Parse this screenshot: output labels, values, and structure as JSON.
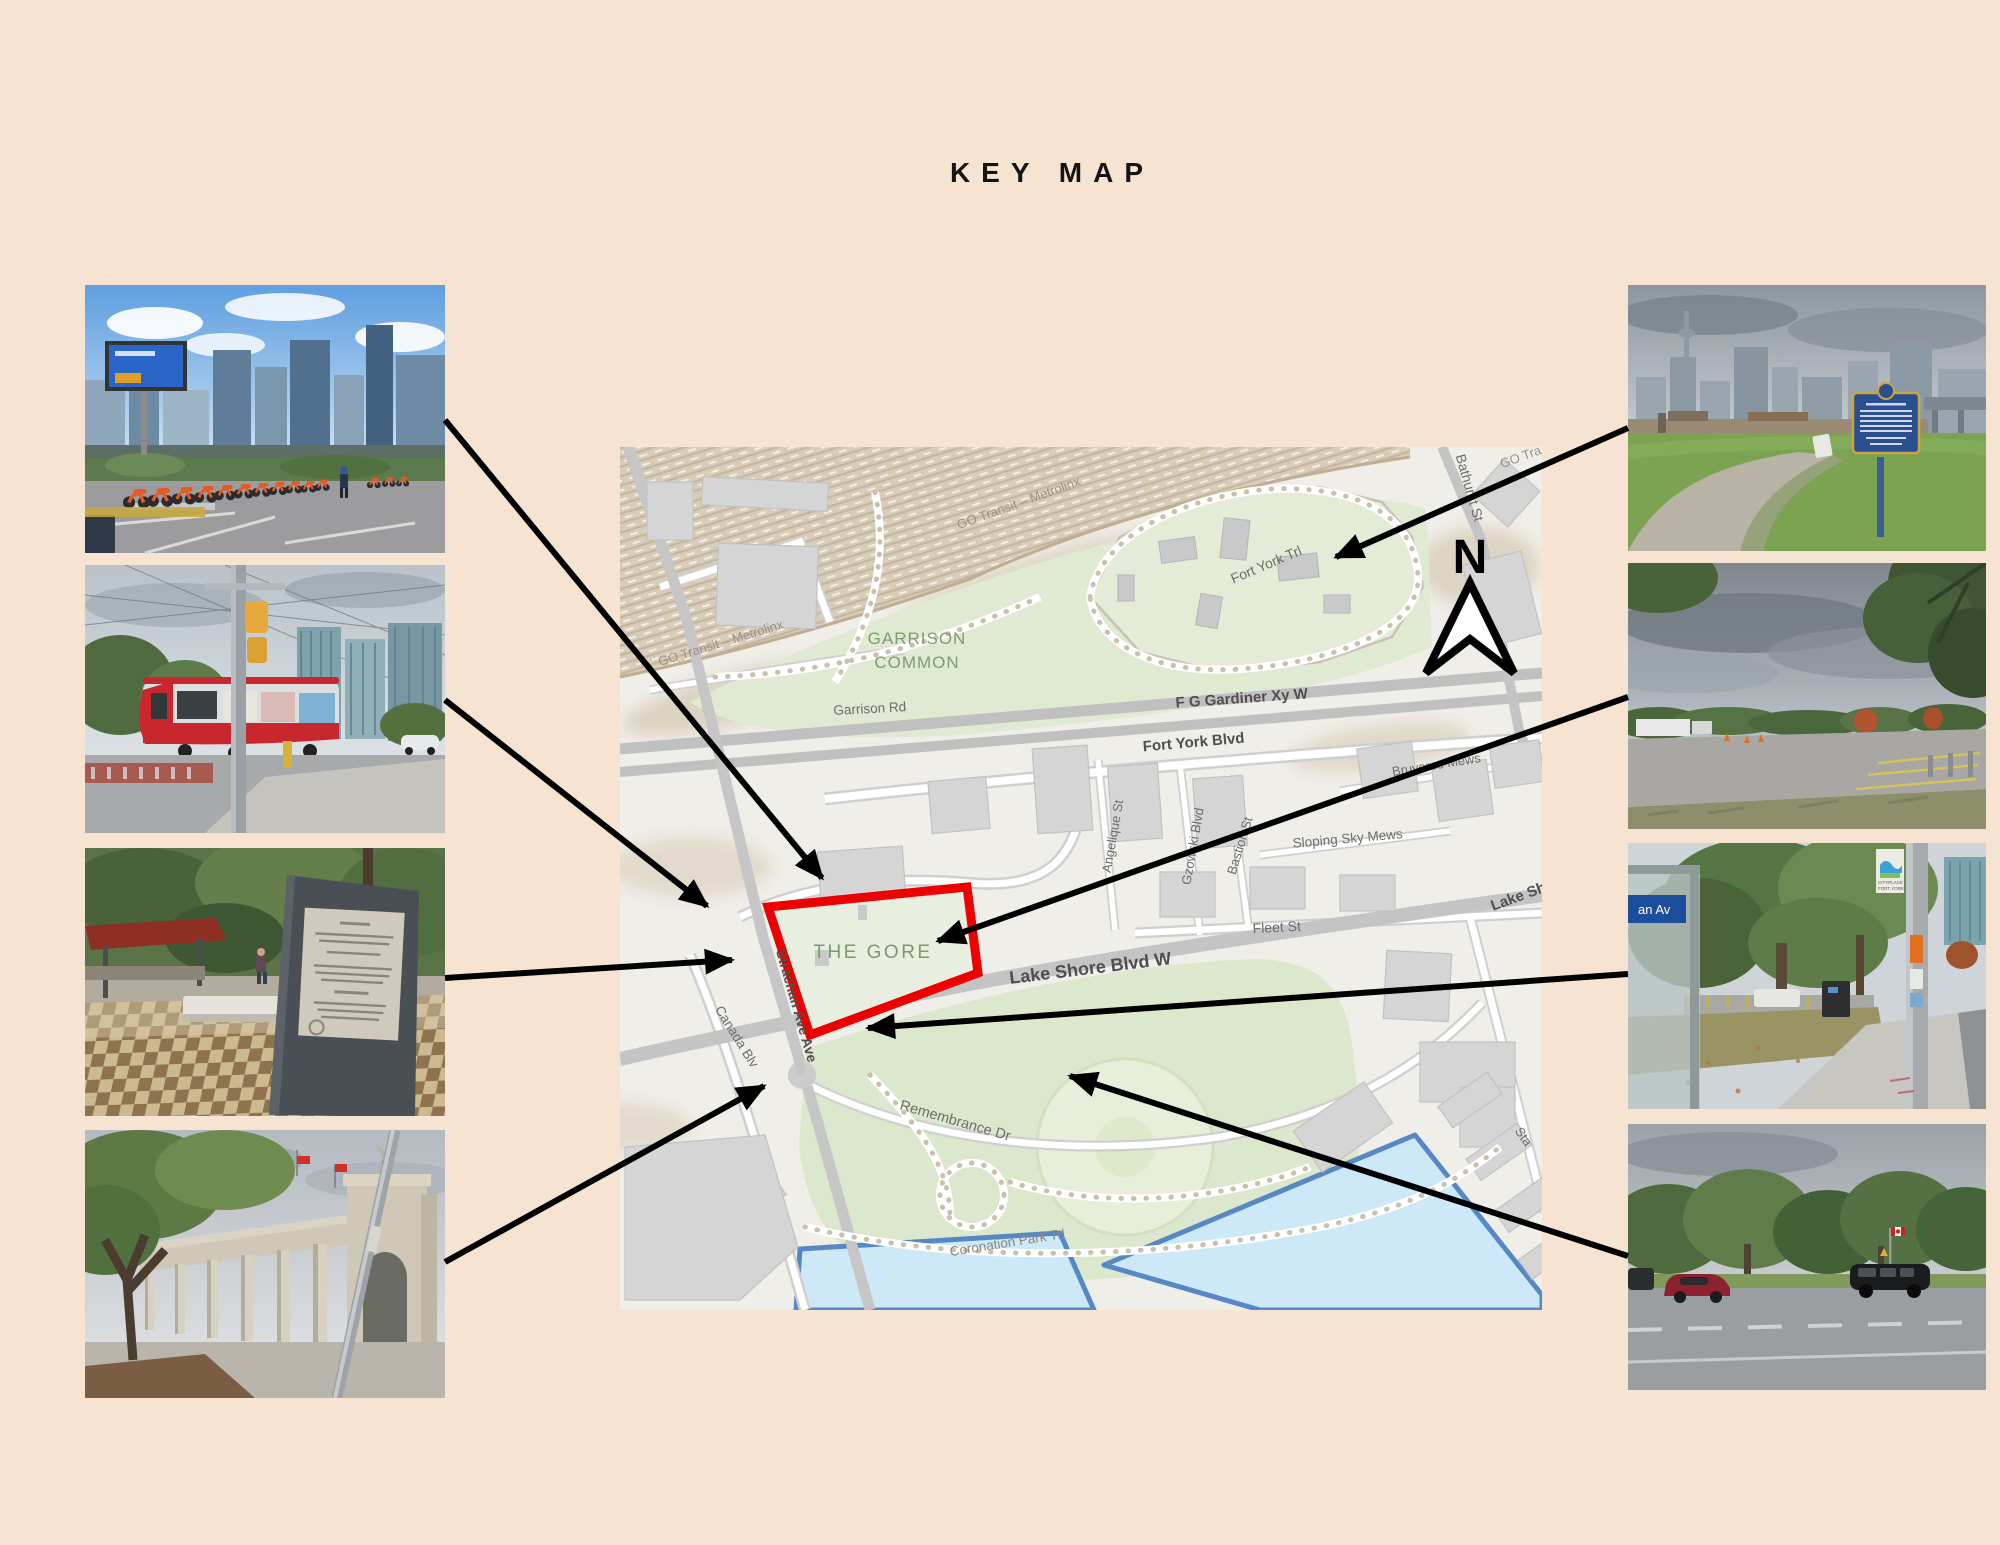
{
  "title": "KEY MAP",
  "map": {
    "labels": {
      "go_transit_1": "GO Transit – Metrolinx",
      "go_transit_2": "GO Transit – Metrolinx",
      "go_transit_3": "GO Tra",
      "garrison_common_1": "GARRISON",
      "garrison_common_2": "COMMON",
      "garrison_rd": "Garrison Rd",
      "fort_york_trl": "Fort York Trl",
      "gardiner": "F G Gardiner Xy W",
      "fort_york_blvd": "Fort York Blvd",
      "bruyeres_mews": "Bruyeres Mews",
      "sloping_sky_mews": "Sloping Sky Mews",
      "angelique_st": "Angelique St",
      "gzowski_blvd": "Gzowski Blvd",
      "bastion_st": "Bastion St",
      "fleet_st": "Fleet St",
      "lake_shore_blvd": "Lake Shore Blvd W",
      "lake_shore_partial": "Lake Sh",
      "bathurst_st": "Bathurst St",
      "strachan_ave": "Strachan Ave Ave",
      "canada_blvd": "Canada Blv",
      "the_gore": "THE GORE",
      "remembrance_dr": "Remembrance Dr",
      "coronation_park_trl": "Coronation Park Trl",
      "stadium_rd_partial": "Sta"
    },
    "compass": "N",
    "colors": {
      "background": "#f7e3d2",
      "highlight_red": "#ec0000",
      "park_green": "#dfe9d2",
      "water_fill": "#cde9f7",
      "water_border": "#5588c5"
    }
  },
  "photos": {
    "left": [
      "bike-share-station",
      "ttc-streetcar",
      "memorial-plaza",
      "princes-gates-colonnade"
    ],
    "right": [
      "fort-york-plaque",
      "gravel-parking-lot",
      "strachan-ave-bus-stop",
      "lake-shore-blvd-traffic"
    ]
  },
  "photo_texts": {
    "shelter_sign": "an Av",
    "banner_line1": "CITYPLACE",
    "banner_line2": "FORT YORK"
  }
}
